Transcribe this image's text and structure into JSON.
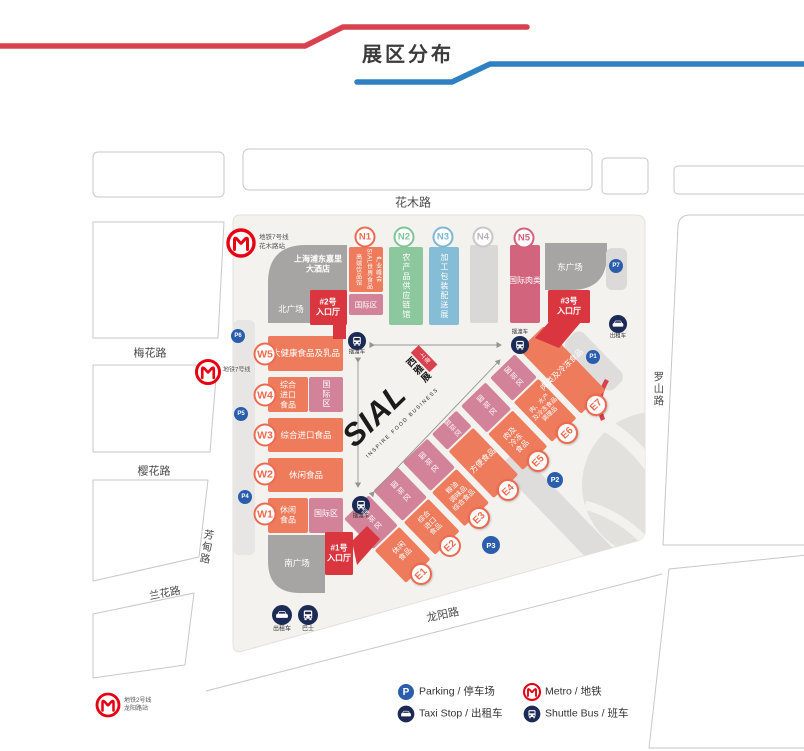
{
  "header": {
    "title": "展区分布"
  },
  "roads": {
    "huamu": "花木路",
    "meihua": "梅花路",
    "yinghua": "樱花路",
    "lanhua": "兰花路",
    "fangdian": "芳甸路",
    "luoshan": "罗山路",
    "longyang": "龙阳路"
  },
  "metro": {
    "line7_station": "地铁7号线\n花木路站",
    "line7": "地铁7号线",
    "line2_station": "地铁2号线\n龙阳路站"
  },
  "buildings": {
    "hotel": "上海浦东嘉里\n大酒店",
    "north_square": "北广场",
    "east_square": "东广场",
    "south_square": "南广场"
  },
  "entrances": {
    "no2": "#2号\n入口厅",
    "no3": "#3号\n入口厅",
    "no1": "#1号\n入口厅"
  },
  "logo": {
    "name": "SIAL",
    "cn": "西雅展",
    "city": "上海",
    "tagline": "INSPIRE FOOD BUSINESS"
  },
  "halls": {
    "n1": {
      "id": "N1",
      "line1": "高端饮品馆",
      "line2": "SIAL世界食品",
      "line3": "产业峰会",
      "intl": "国际区"
    },
    "n2": {
      "id": "N2",
      "label": "农产品供应链馆"
    },
    "n3": {
      "id": "N3",
      "label": "加工包装配送展"
    },
    "n4": {
      "id": "N4"
    },
    "n5": {
      "id": "N5",
      "label": "国际肉类"
    },
    "w5": {
      "id": "W5",
      "label": "大健康食品及乳品"
    },
    "w4": {
      "id": "W4",
      "label": "综合\n进口\n食品",
      "intl": "国际区"
    },
    "w3": {
      "id": "W3",
      "label": "综合进口食品"
    },
    "w2": {
      "id": "W2",
      "label": "休闲食品"
    },
    "w1": {
      "id": "W1",
      "label": "休闲\n食品",
      "intl": "国际区"
    },
    "e1": {
      "id": "E1",
      "label": "休闲\n食品",
      "intl": "国际区"
    },
    "e2": {
      "id": "E2",
      "label": "综合\n进口\n食品",
      "intl": "国际区"
    },
    "e3": {
      "id": "E3",
      "label": "粮油\n调味品\n综合食品",
      "intl": "国际区"
    },
    "e4": {
      "id": "E4",
      "label": "方便食品",
      "intl": "国际区"
    },
    "e5": {
      "id": "E5",
      "label": "肉及\n冷冻\n食品",
      "intl": "国际区"
    },
    "e6": {
      "id": "E6",
      "label": "肉、水产\n及冷冻食品\n调理品",
      "intl": "国际区"
    },
    "e7": {
      "id": "E7",
      "label": "肉类及冷冻食品"
    }
  },
  "parking": {
    "p1": "P1",
    "p2": "P2",
    "p3": "P3",
    "p4": "P4",
    "p5": "P5",
    "p6": "P6",
    "p7": "P7",
    "p": "P"
  },
  "transport": {
    "shuttle": "摆渡车",
    "taxi": "出租车",
    "bus": "巴士"
  },
  "legend": {
    "parking": "Parking / 停车场",
    "taxi": "Taxi Stop / 出租车",
    "metro": "Metro / 地铁",
    "shuttle": "Shuttle Bus / 班车"
  },
  "colors": {
    "orange": "#ee7b5b",
    "pink": "#d2839a",
    "red": "#d93640",
    "green": "#8cc79e",
    "blue": "#85bcd6",
    "navy": "#1c2b55",
    "metro_red": "#e60012",
    "p_blue": "#2a5dab"
  }
}
